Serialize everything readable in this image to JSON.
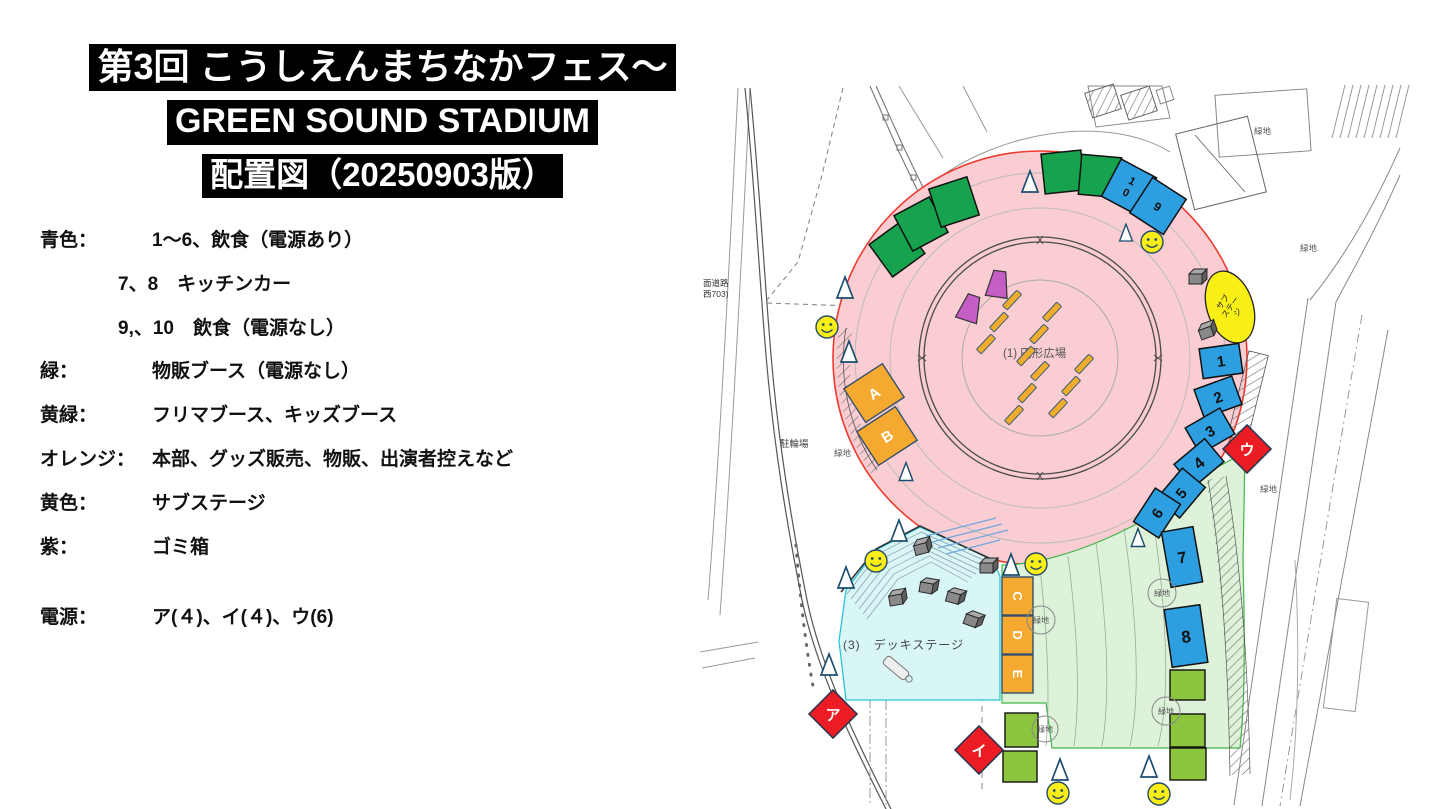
{
  "header": {
    "title_line1": "第3回 こうしえんまちなかフェス〜",
    "title_line2": "GREEN SOUND STADIUM",
    "title_line3": "配置図（20250903版）"
  },
  "legend": {
    "rows": [
      {
        "label": "青色：",
        "text": "1〜6、飲食（電源あり）",
        "indent": false
      },
      {
        "label": "",
        "text": "7、8　キッチンカー",
        "indent": true
      },
      {
        "label": "",
        "text": "9,、10　飲食（電源なし）",
        "indent": true
      },
      {
        "label": "緑：",
        "text": "物販ブース（電源なし）",
        "indent": false
      },
      {
        "label": "黄緑：",
        "text": "フリマブース、キッズブース",
        "indent": false
      },
      {
        "label": "オレンジ：",
        "text": "本部、グッズ販売、物販、出演者控えなど",
        "indent": false
      },
      {
        "label": "黄色：",
        "text": "サブステージ",
        "indent": false
      },
      {
        "label": "紫：",
        "text": "ゴミ箱",
        "indent": false
      },
      {
        "label": "電源：",
        "text": "ア(４)、イ(４)、ウ(6)",
        "indent": false
      }
    ]
  },
  "map": {
    "plaza_label": "(1) 円形広場",
    "deck_label": "(3)　デッキステージ",
    "sub_stage_lines": [
      "サブ",
      "ステー",
      "ジ"
    ],
    "bicycle_parking": "駐輪場",
    "road_label_1": "面道路",
    "road_label_2": "西703)",
    "green_space": "緑地",
    "blue_numbers": [
      "1",
      "2",
      "3",
      "4",
      "5",
      "6",
      "7",
      "8",
      "9"
    ],
    "blue_ten": [
      "1",
      "0"
    ],
    "orange_letters": [
      "A",
      "B",
      "C",
      "D",
      "E"
    ],
    "power_marks": [
      "ア",
      "イ",
      "ウ"
    ],
    "colors": {
      "blue_booth": "#2d9fe0",
      "green_booth": "#17a34d",
      "yellowgreen_booth": "#8cc63e",
      "orange_booth": "#f5a930",
      "substage_yellow": "#f8ef15",
      "trash_purple": "#c45ec4",
      "power_red": "#ec1c24",
      "plaza_pink": "#f9cdd2",
      "lawn_green": "#def2d9",
      "deck_cyan": "#d8f6f6"
    }
  }
}
